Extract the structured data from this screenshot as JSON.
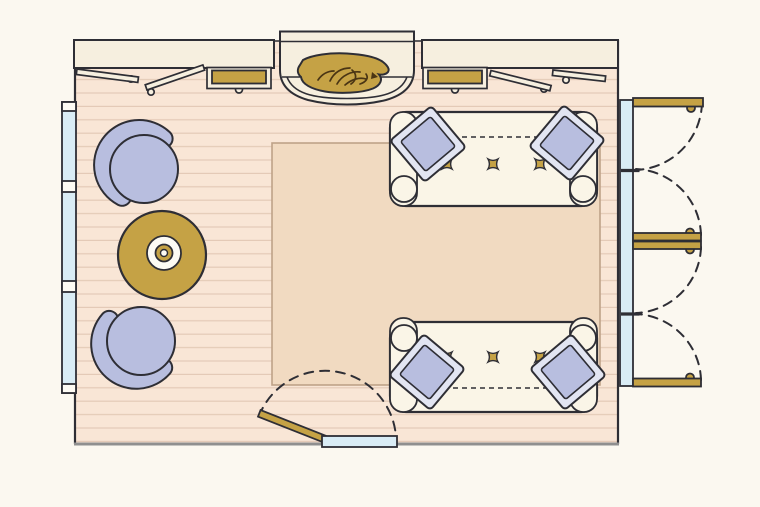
{
  "diagram": {
    "type": "floor-plan",
    "room": "living-room",
    "elements": [
      {
        "id": "fireplace",
        "label": "fireplace with burning logs",
        "position": "top-center"
      },
      {
        "id": "built-in-cabinet-left",
        "label": "built-in cabinet with two open doors and gold drawer",
        "position": "top-left"
      },
      {
        "id": "built-in-cabinet-right",
        "label": "built-in cabinet with gold drawer and two open doors",
        "position": "top-right"
      },
      {
        "id": "window-left",
        "label": "window wall with three sashes",
        "position": "left"
      },
      {
        "id": "armchair-top",
        "label": "round barrel armchair",
        "position": "left-upper"
      },
      {
        "id": "armchair-bottom",
        "label": "round barrel armchair",
        "position": "left-lower"
      },
      {
        "id": "coffee-table",
        "label": "round gold table with tray",
        "position": "left-center"
      },
      {
        "id": "area-rug",
        "label": "rectangular area rug",
        "position": "center"
      },
      {
        "id": "sofa-top",
        "label": "sofa with two throw pillows and three tufting buttons",
        "position": "right-upper"
      },
      {
        "id": "sofa-bottom",
        "label": "sofa with two throw pillows and three tufting buttons",
        "position": "right-lower"
      },
      {
        "id": "french-doors-upper",
        "label": "double french doors swinging outward",
        "position": "right-upper-wall"
      },
      {
        "id": "french-doors-lower",
        "label": "double french doors swinging outward",
        "position": "right-lower-wall"
      },
      {
        "id": "entry-door",
        "label": "single door with swing arc",
        "position": "bottom"
      }
    ]
  },
  "colors": {
    "page_bg": "#fbf8f0",
    "floor": "#f9e6d6",
    "plank_line": "#e4cab7",
    "rug": "#f1dac1",
    "rug_border": "#bfa288",
    "cream": "#f6efdf",
    "sofa": "#faf5e7",
    "lavender": "#b8bedf",
    "pillow_flange": "#e2e5f2",
    "gold": "#c5a245",
    "glass": "#d9ecf5",
    "outline": "#2e2e35",
    "wall_gray": "#8f8f8f",
    "log": "#4a3514",
    "white": "#fdfbf4"
  }
}
